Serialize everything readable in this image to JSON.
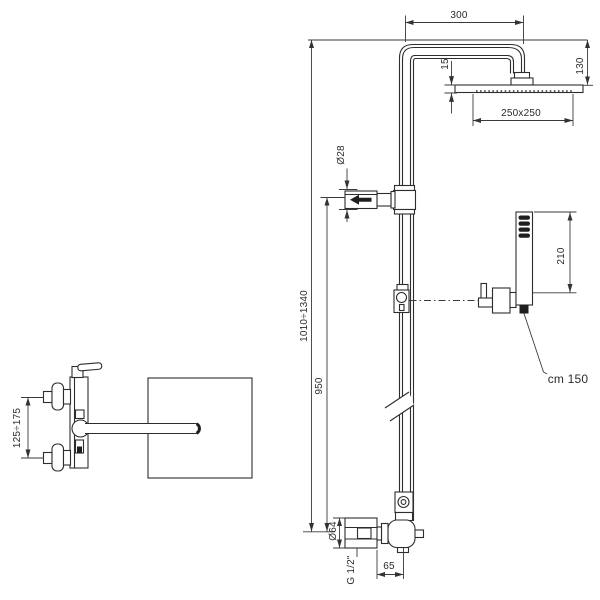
{
  "labels": {
    "dim_300": "300",
    "dim_130": "130",
    "dim_15": "15",
    "dim_head": "250x250",
    "dim_pipe_dia": "Ø28",
    "dim_height_range": "1010÷1340",
    "dim_950": "950",
    "dim_210": "210",
    "hose_length": "cm 150",
    "dim_mixer_spacing": "125÷175",
    "dim_flange": "Ø64",
    "thread": "G 1/2\"",
    "dim_65": "65"
  },
  "colors": {
    "line": "#2d2d2d",
    "dimension_line": "#3a3a3a",
    "background": "#ffffff"
  }
}
